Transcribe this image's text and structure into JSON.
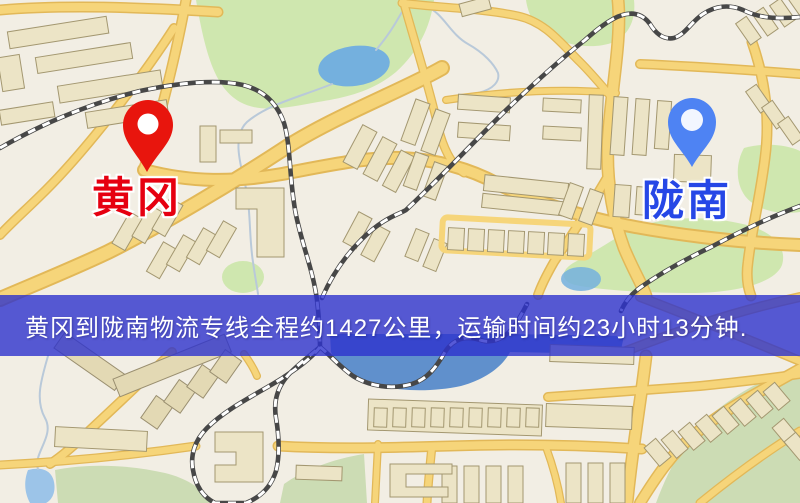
{
  "banner": {
    "text": "黄冈到陇南物流专线全程约1427公里，运输时间约23小时13分钟."
  },
  "markers": {
    "origin": {
      "label": "黄冈"
    },
    "destination": {
      "label": "陇南"
    }
  },
  "colors": {
    "banner_bg": "rgba(45,50,205,0.8)",
    "banner_text": "#ffffff",
    "origin_pin": "#e8150d",
    "origin_label": "#e60010",
    "destination_pin": "#4e83f3",
    "destination_label": "#2647e6",
    "map_bg": "#f2eee4",
    "road": "#f6d57a",
    "road_casing": "#e2b858",
    "park": "#cfe7af",
    "water": "#74b0de",
    "building": "#ece4c6",
    "building_line": "#a39770",
    "rail_dark": "#474747"
  }
}
